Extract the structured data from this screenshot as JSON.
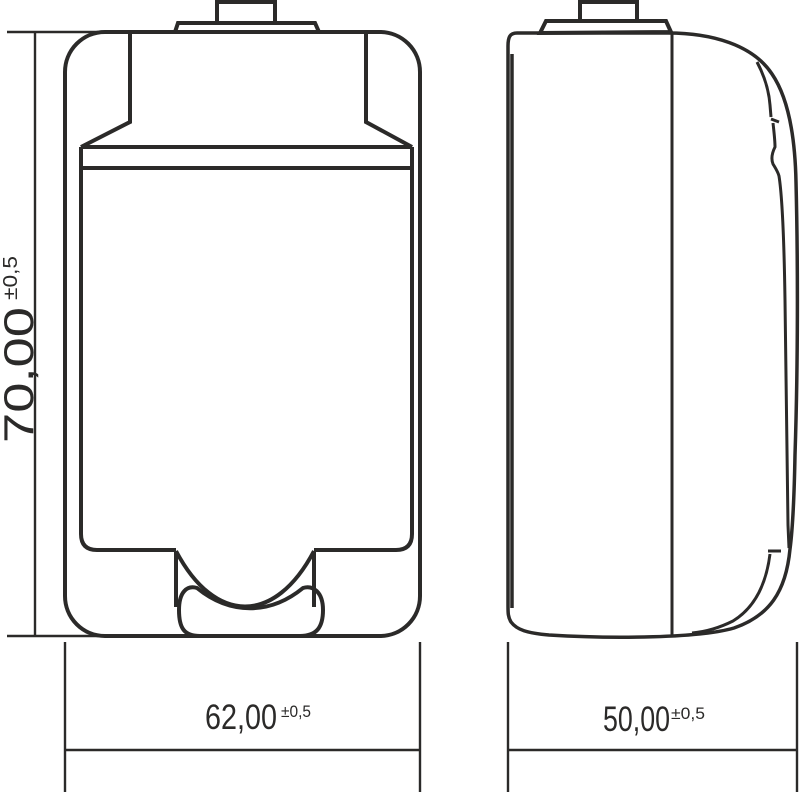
{
  "dimensions": {
    "height": {
      "value": "70,00",
      "tolerance": "±0,5"
    },
    "width": {
      "value": "62,00",
      "tolerance": "±0,5"
    },
    "depth": {
      "value": "50,00",
      "tolerance": "±0,5"
    }
  },
  "colors": {
    "line": "#2b2a29",
    "background": "#ffffff"
  }
}
